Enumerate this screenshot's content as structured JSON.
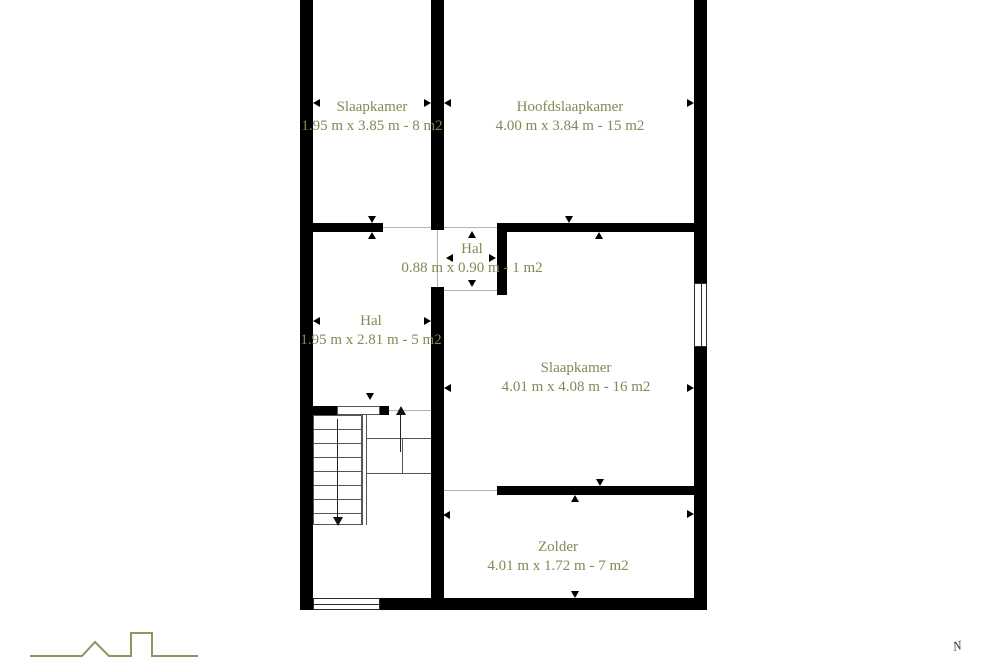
{
  "title": "Floor plan - Zolder verdieping (attic storey plattegrond)",
  "colors": {
    "wall": "#000000",
    "room_text": "#7d8c55",
    "logo_line": "#8a9a5e",
    "opening_line": "#b3b3b3"
  },
  "rooms": [
    {
      "id": "slaapkamer-top",
      "name": "Slaapkamer",
      "dims": "1.95 m x 3.85 m - 8 m2"
    },
    {
      "id": "hoofdslaapkamer",
      "name": "Hoofdslaapkamer",
      "dims": "4.00 m x 3.84 m - 15 m2"
    },
    {
      "id": "hal-klein",
      "name": "Hal",
      "dims": "0.88 m x 0.90 m - 1 m2"
    },
    {
      "id": "hal",
      "name": "Hal",
      "dims": "1.95 m x 2.81 m - 5 m2"
    },
    {
      "id": "slaapkamer-rechts",
      "name": "Slaapkamer",
      "dims": "4.01 m x 4.08 m - 16 m2"
    },
    {
      "id": "zolder",
      "name": "Zolder",
      "dims": "4.01 m x 1.72 m - 7 m2"
    }
  ],
  "compass": {
    "label": "N"
  },
  "icons": {
    "logo": "house-skyline-outline-icon",
    "compass": "north-indicator"
  }
}
